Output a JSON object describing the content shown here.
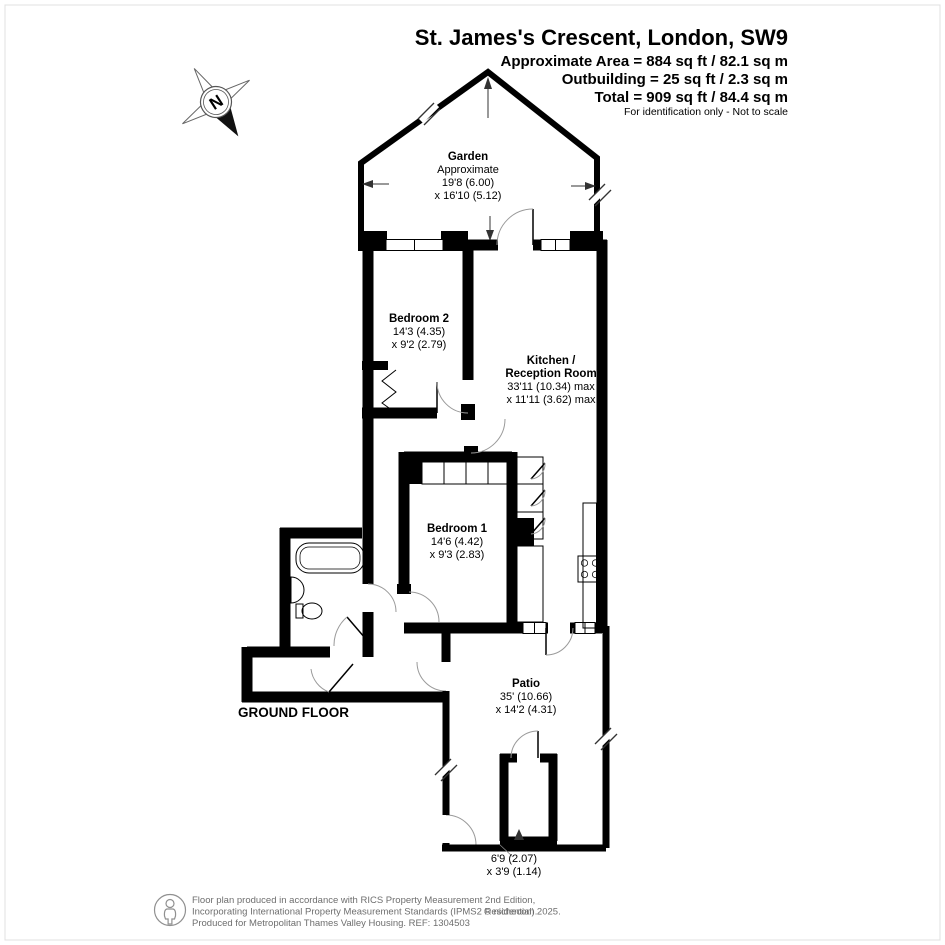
{
  "header": {
    "title": "St. James's Crescent, London, SW9",
    "area_line1": "Approximate Area = 884 sq ft / 82.1 sq m",
    "area_line2": "Outbuilding = 25 sq ft / 2.3 sq m",
    "area_line3": "Total = 909 sq ft / 84.4 sq m",
    "disclaimer": "For identification only - Not to scale"
  },
  "compass": {
    "label": "N"
  },
  "floor_label": "GROUND FLOOR",
  "rooms": {
    "garden": {
      "name": "Garden",
      "note": "Approximate",
      "dim1": "19'8 (6.00)",
      "dim2": "x 16'10 (5.12)"
    },
    "bedroom2": {
      "name": "Bedroom 2",
      "dim1": "14'3 (4.35)",
      "dim2": "x 9'2 (2.79)"
    },
    "kitchen": {
      "name1": "Kitchen /",
      "name2": "Reception Room",
      "dim1": "33'11 (10.34) max",
      "dim2": "x 11'11 (3.62) max"
    },
    "bedroom1": {
      "name": "Bedroom 1",
      "dim1": "14'6 (4.42)",
      "dim2": "x 9'3 (2.83)"
    },
    "patio": {
      "name": "Patio",
      "dim1": "35' (10.66)",
      "dim2": "x 14'2 (4.31)"
    },
    "outbuilding": {
      "dim1": "6'9 (2.07)",
      "dim2": "x 3'9 (1.14)"
    }
  },
  "footer": {
    "line1": "Floor plan produced in accordance with RICS Property Measurement 2nd Edition,",
    "line2": "Incorporating International Property Measurement Standards (IPMS2 Residential).",
    "copyright": "© nichecom 2025.",
    "line3": "Produced for Metropolitan Thames Valley Housing.   REF: 1304503"
  },
  "colors": {
    "wall": "#000000",
    "door_arc": "#9a9a9a",
    "footer_text": "#6e6e6e"
  }
}
